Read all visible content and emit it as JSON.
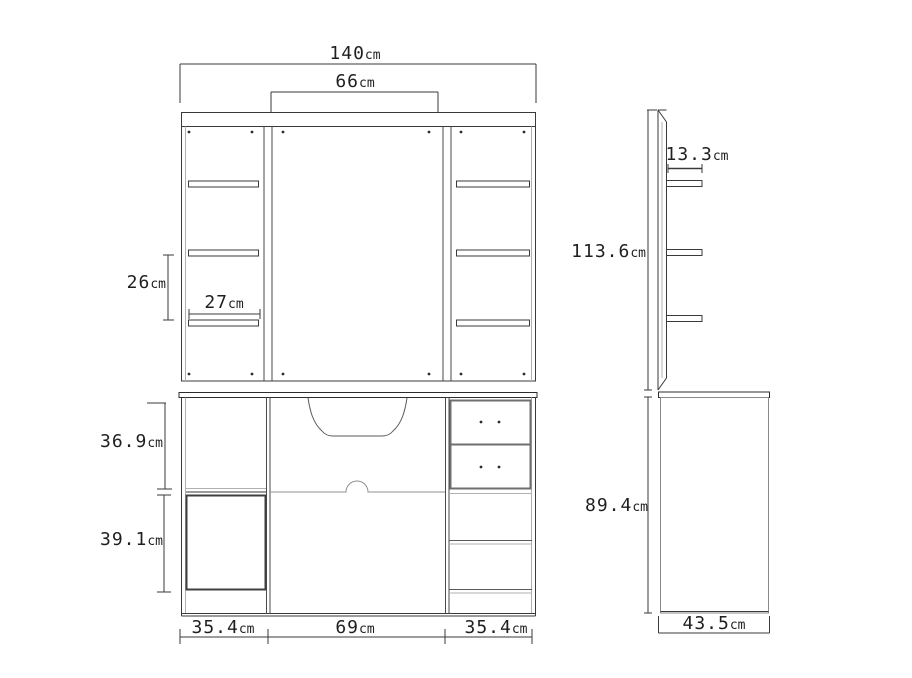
{
  "labels": {
    "overall_width": {
      "value": "140",
      "unit": "cm"
    },
    "mirror_width": {
      "value": "66",
      "unit": "cm"
    },
    "shelf_gap": {
      "value": "26",
      "unit": "cm"
    },
    "shelf_width": {
      "value": "27",
      "unit": "cm"
    },
    "upper_section_height": {
      "value": "36.9",
      "unit": "cm"
    },
    "lower_section_height": {
      "value": "39.1",
      "unit": "cm"
    },
    "bottom_left_width": {
      "value": "35.4",
      "unit": "cm"
    },
    "bottom_center_width": {
      "value": "69",
      "unit": "cm"
    },
    "bottom_right_width": {
      "value": "35.4",
      "unit": "cm"
    },
    "side_shelf_depth": {
      "value": "13.3",
      "unit": "cm"
    },
    "upper_height": {
      "value": "113.6",
      "unit": "cm"
    },
    "lower_height": {
      "value": "89.4",
      "unit": "cm"
    },
    "side_depth": {
      "value": "43.5",
      "unit": "cm"
    }
  },
  "colors": {
    "line_dark": "#3a3a3a",
    "line_mid": "#6f6f6f",
    "line_light": "#b0b0b0",
    "background": "#ffffff"
  }
}
